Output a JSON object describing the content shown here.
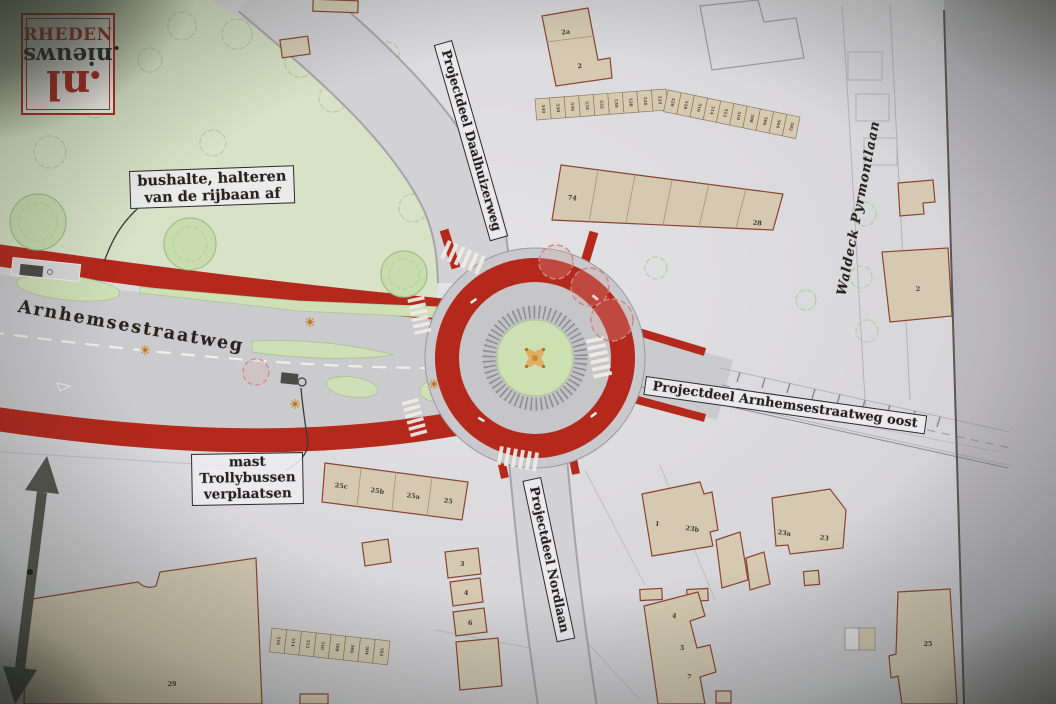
{
  "logo": {
    "rheden": "RHEDEN",
    "nieuws": "nieuws",
    "nl": "nl"
  },
  "map": {
    "street_labels": {
      "arnhemsestraatweg": "Arnhemsestraatweg",
      "projectdeel_daalhuizerweg": "Projectdeel Daalhuizerweg",
      "waldeck_pyrmontlaan": "Waldeck Pyrmontlaan",
      "projectdeel_arnhemsestraatweg_oost": "Projectdeel Arnhemsestraatweg oost",
      "projectdeel_nordlaan": "Projectdeel Nordlaan"
    },
    "annotations": {
      "bushalte": {
        "line1": "bushalte, halteren",
        "line2": "van de rijbaan af"
      },
      "mast": {
        "line1": "mast",
        "line2": "Trollybussen",
        "line3": "verplaatsen"
      }
    },
    "buildings": {
      "b2a": {
        "label": "2a"
      },
      "b2_top": {
        "label": "2"
      },
      "b74_28": {
        "label_left": "74",
        "label_right": "28"
      },
      "b2_right": {
        "label": "2"
      },
      "b25_row": {
        "labels": [
          "25c",
          "25b",
          "25a",
          "25"
        ]
      },
      "b1_23b": {
        "label_left": "1",
        "label_right": "23b"
      },
      "b23a_23": {
        "label_left": "23a",
        "label_right": "23"
      },
      "b29": {
        "label": "29"
      },
      "b_stepped_south": {
        "labels": [
          "4",
          "5",
          "7"
        ]
      },
      "b25_tall": {
        "label": "25"
      },
      "b_small_column": {
        "labels": [
          "3",
          "4",
          "6"
        ]
      }
    },
    "house_rows": [
      {
        "name": "house-row-north-west",
        "numbers": [
          "540",
          "538",
          "536",
          "534",
          "532",
          "530",
          "528",
          "526",
          "524"
        ]
      },
      {
        "name": "house-row-north-east",
        "numbers": [
          "520",
          "518",
          "516",
          "514",
          "512",
          "510",
          "508",
          "506",
          "504",
          "502"
        ]
      },
      {
        "name": "house-row-south-west",
        "numbers": [
          "516",
          "514",
          "512",
          "510",
          "508",
          "506",
          "504",
          "502"
        ]
      }
    ],
    "colors": {
      "road_red": "#b5281c",
      "road_gray": "#cbcacd",
      "park_green": "#d7e2c6",
      "island_green": "#cfe0b6",
      "building_tan": "#d5cab1",
      "building_outline": "#8a4433",
      "paper": "#dcdbde",
      "north_arrow": "#54554e",
      "logo_red": "#b8241c"
    }
  }
}
